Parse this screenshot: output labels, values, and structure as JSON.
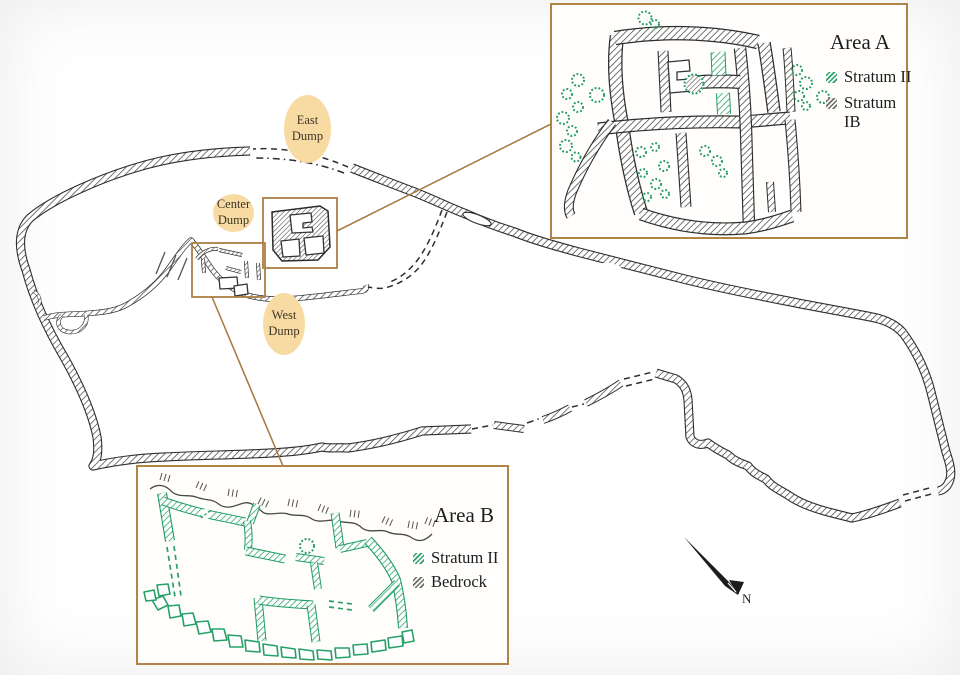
{
  "map": {
    "dumps": [
      {
        "id": "east",
        "line1": "East",
        "line2": "Dump"
      },
      {
        "id": "center",
        "line1": "Center",
        "line2": "Dump"
      },
      {
        "id": "west",
        "line1": "West",
        "line2": "Dump"
      }
    ],
    "compass": {
      "label": "N"
    }
  },
  "insets": {
    "area_a": {
      "title": "Area A",
      "legend": [
        {
          "label": "Stratum II",
          "swatch": "green-hatch"
        },
        {
          "label": "Stratum",
          "label2": "IB",
          "swatch": "gray-hatch"
        }
      ]
    },
    "area_b": {
      "title": "Area B",
      "legend": [
        {
          "label": "Stratum II",
          "swatch": "green-hatch"
        },
        {
          "label": "Bedrock",
          "swatch": "gray-hatch"
        }
      ]
    }
  },
  "colors": {
    "stratum_ii_green": "#2aa06b",
    "wall_dark": "#2e2e2e",
    "box_border_brown": "#b18347",
    "dump_fill": "#f7dba3"
  }
}
